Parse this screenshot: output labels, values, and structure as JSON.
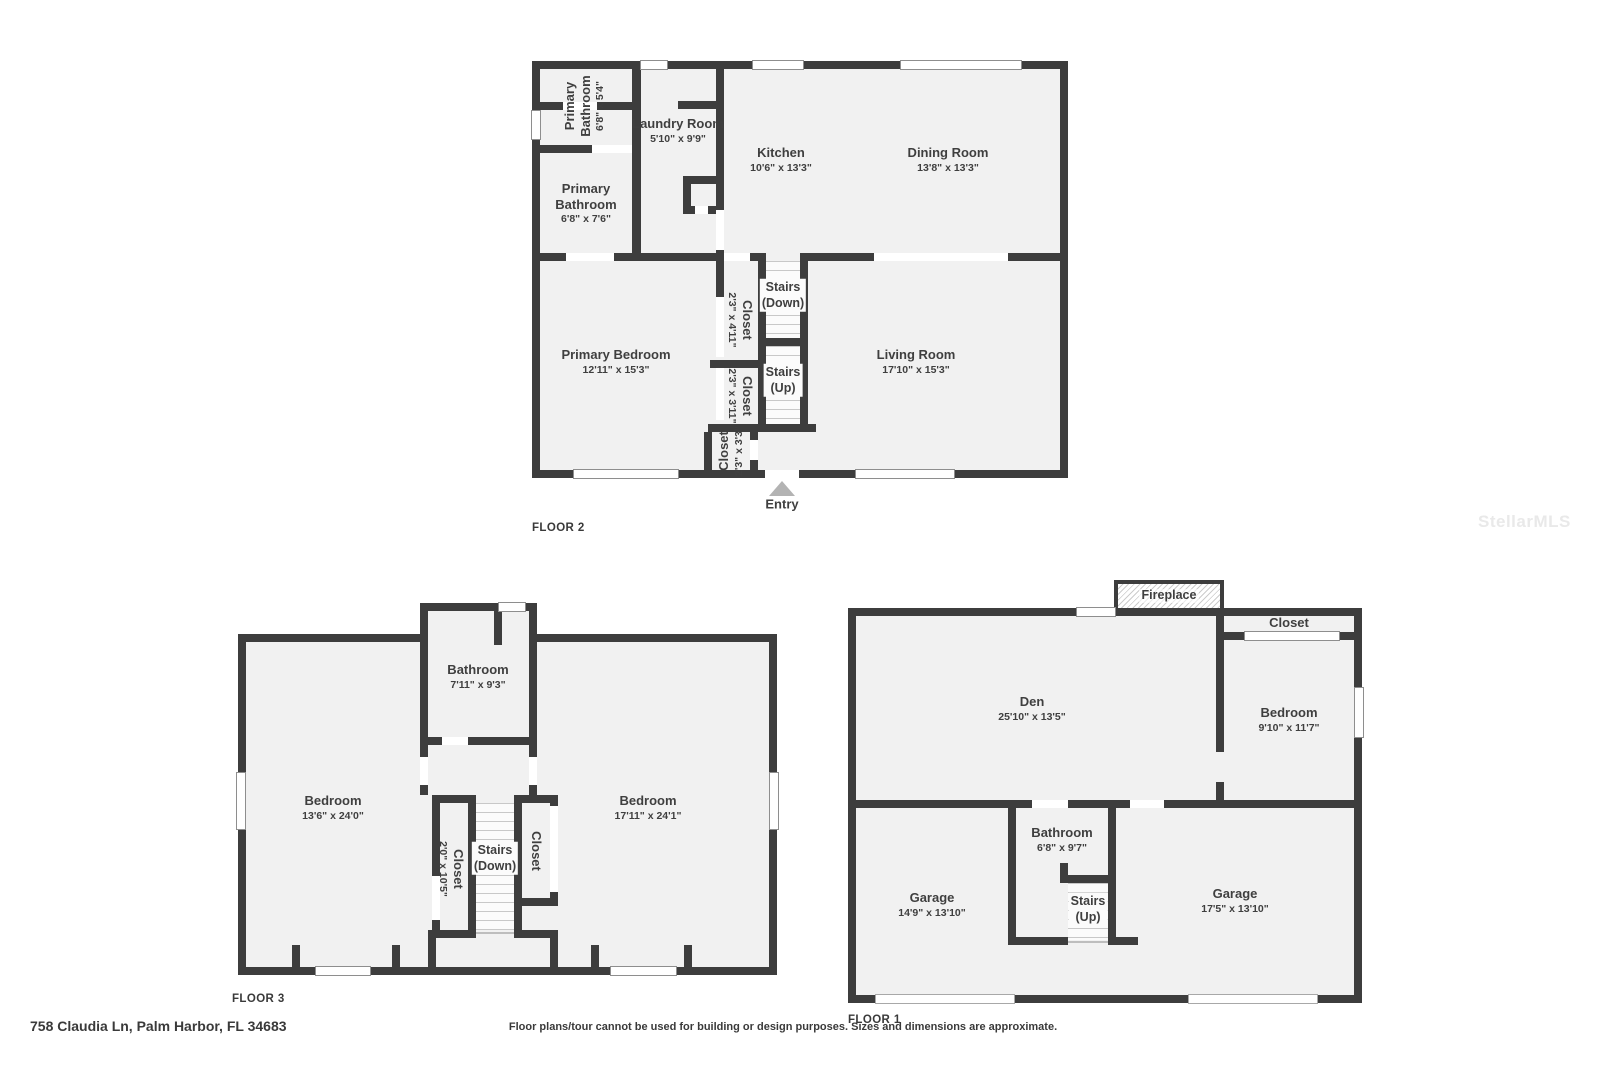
{
  "page": {
    "address": "758 Claudia Ln, Palm Harbor, FL 34683",
    "disclaimer": "Floor plans/tour cannot be used for building or design purposes. Sizes and dimensions are approximate.",
    "watermark": "StellarMLS"
  },
  "colors": {
    "wall": "#3d3d3d",
    "room_fill": "#f1f1f1",
    "label_text": "#3f3f3f",
    "entry_arrow": "#b3b3b3"
  },
  "floor2": {
    "label": "FLOOR 2",
    "entry": "Entry",
    "rooms": {
      "primary_bathroom_upper": {
        "name": "Primary Bathroom",
        "dims": "6'8\" x 5'4\""
      },
      "laundry_room": {
        "name": "Laundry Room",
        "dims": "5'10\" x 9'9\""
      },
      "kitchen": {
        "name": "Kitchen",
        "dims": "10'6\" x 13'3\""
      },
      "dining_room": {
        "name": "Dining Room",
        "dims": "13'8\" x 13'3\""
      },
      "primary_bathroom": {
        "name": "Primary Bathroom",
        "dims": "6'8\" x 7'6\""
      },
      "stairs_down": {
        "name": "Stairs",
        "dims": "(Down)"
      },
      "closet_1": {
        "name": "Closet",
        "dims": "2'3\" x 4'11\""
      },
      "primary_bedroom": {
        "name": "Primary Bedroom",
        "dims": "12'11\" x 15'3\""
      },
      "closet_2": {
        "name": "Closet",
        "dims": "2'3\" x 3'11\""
      },
      "stairs_up": {
        "name": "Stairs",
        "dims": "(Up)"
      },
      "living_room": {
        "name": "Living Room",
        "dims": "17'10\" x 15'3\""
      },
      "closet_3": {
        "name": "Closet",
        "dims": "2'3\" x 3'3\""
      }
    }
  },
  "floor3": {
    "label": "FLOOR 3",
    "rooms": {
      "bathroom": {
        "name": "Bathroom",
        "dims": "7'11\" x 9'3\""
      },
      "bedroom_left": {
        "name": "Bedroom",
        "dims": "13'6\" x 24'0\""
      },
      "bedroom_right": {
        "name": "Bedroom",
        "dims": "17'11\" x 24'1\""
      },
      "closet_left": {
        "name": "Closet",
        "dims": "2'0\" x 10'5\""
      },
      "stairs_down": {
        "name": "Stairs",
        "dims": "(Down)"
      },
      "closet_right": {
        "name": "Closet",
        "dims": ""
      }
    }
  },
  "floor1": {
    "label": "FLOOR 1",
    "rooms": {
      "fireplace": {
        "name": "Fireplace"
      },
      "closet_top": {
        "name": "Closet"
      },
      "den": {
        "name": "Den",
        "dims": "25'10\" x 13'5\""
      },
      "bedroom": {
        "name": "Bedroom",
        "dims": "9'10\" x 11'7\""
      },
      "bathroom": {
        "name": "Bathroom",
        "dims": "6'8\" x 9'7\""
      },
      "stairs_up": {
        "name": "Stairs",
        "dims": "(Up)"
      },
      "garage_left": {
        "name": "Garage",
        "dims": "14'9\" x 13'10\""
      },
      "garage_right": {
        "name": "Garage",
        "dims": "17'5\" x 13'10\""
      }
    }
  }
}
